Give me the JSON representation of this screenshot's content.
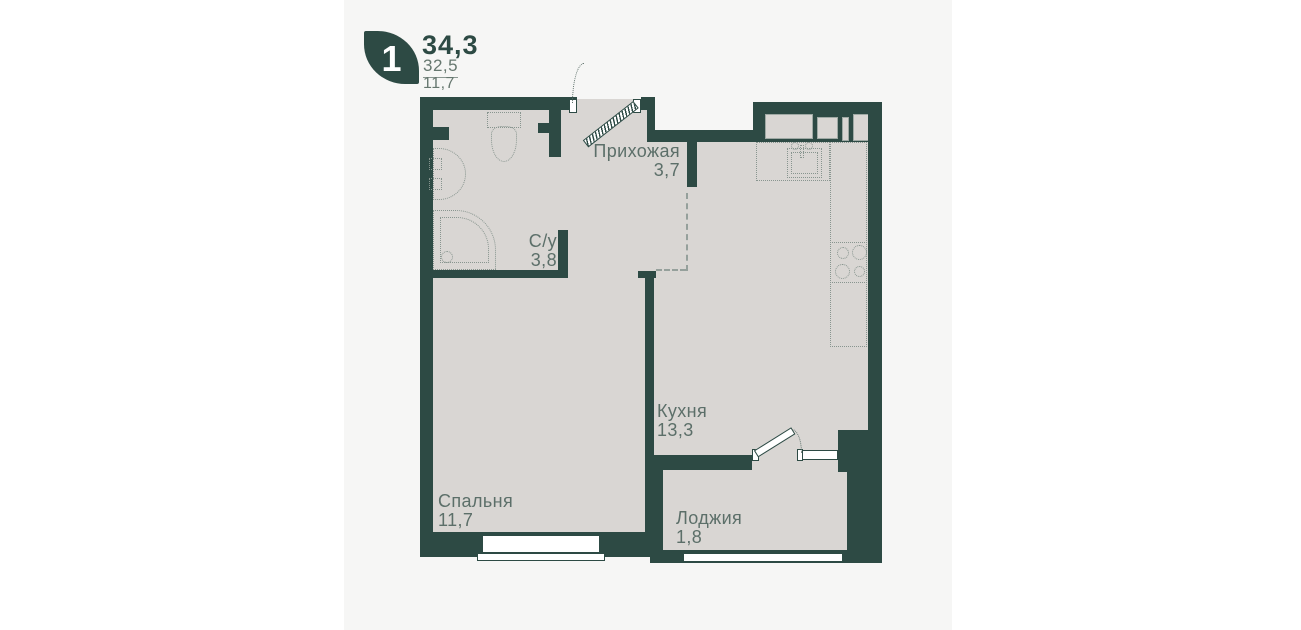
{
  "badge": {
    "rooms": "1",
    "area_total": "34,3",
    "area_living": "32,5",
    "area_extra": "11,7"
  },
  "rooms": {
    "hallway": {
      "name": "Прихожая",
      "area": "3,7"
    },
    "bathroom": {
      "name": "С/у",
      "area": "3,8"
    },
    "kitchen": {
      "name": "Кухня",
      "area": "13,3"
    },
    "bedroom": {
      "name": "Спальня",
      "area": "11,7"
    },
    "loggia": {
      "name": "Лоджия",
      "area": "1,8"
    }
  },
  "colors": {
    "wall": "#2d4a44",
    "floor": "#d9d6d3",
    "panel": "#f6f6f5",
    "label_text": "#5c6f69"
  }
}
